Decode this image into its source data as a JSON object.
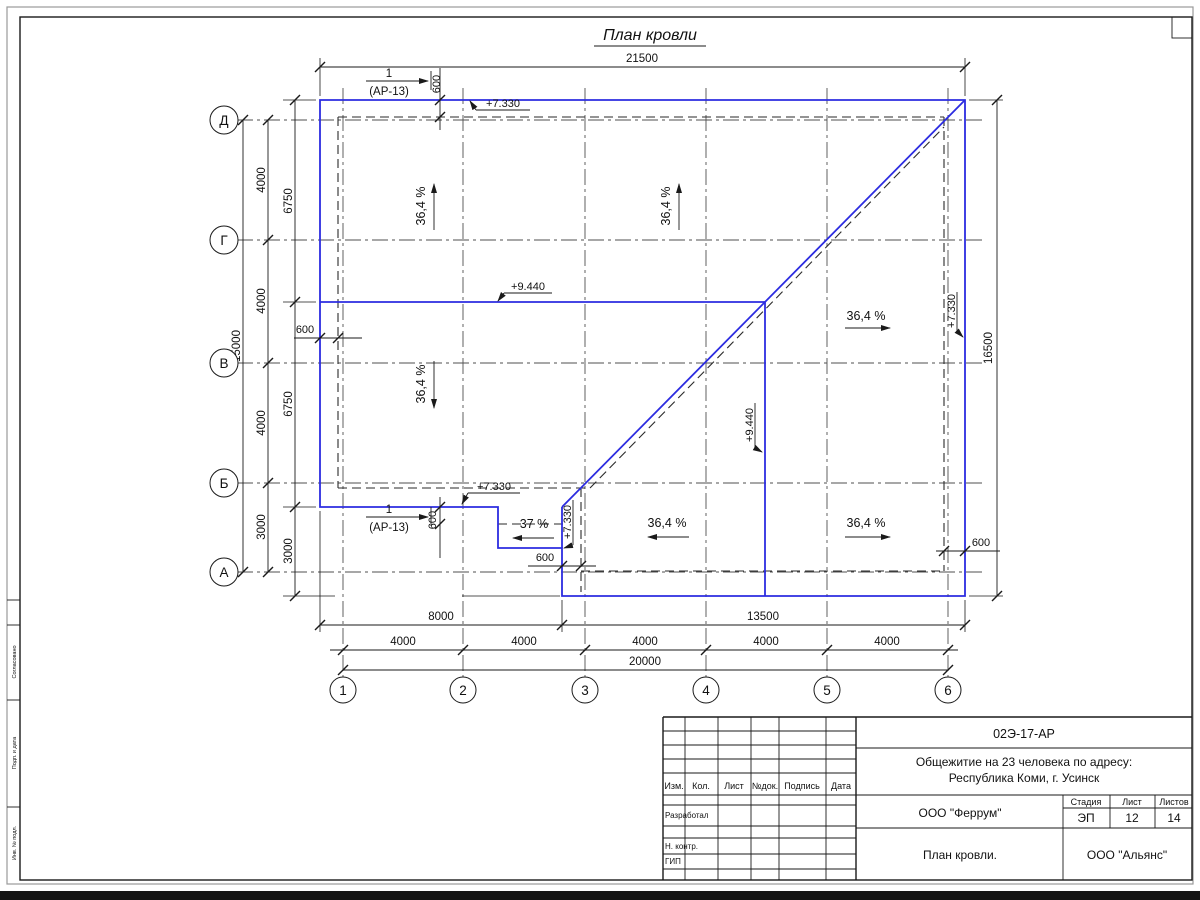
{
  "sheet": {
    "title": "План кровли"
  },
  "axes": {
    "rows": [
      "Д",
      "Г",
      "В",
      "Б",
      "А"
    ],
    "cols": [
      "1",
      "2",
      "3",
      "4",
      "5",
      "6"
    ]
  },
  "dims": {
    "top_total": "21500",
    "left_total": "15000",
    "left_axes": [
      "4000",
      "4000",
      "4000",
      "3000"
    ],
    "left_inner": [
      "6750",
      "6750",
      "3000"
    ],
    "right_total": "16500",
    "bottom_main": [
      "8000",
      "13500"
    ],
    "bottom_axes": [
      "4000",
      "4000",
      "4000",
      "4000",
      "4000"
    ],
    "bottom_total": "20000",
    "overhang": "600"
  },
  "marks": {
    "elev_roof_low": "+7.330",
    "elev_roof_high": "+9.440",
    "section_num": "1",
    "section_ref": "(АР-13)"
  },
  "slopes": {
    "main": "36,4 %",
    "porch": "37 %"
  },
  "title_block": {
    "doc_number": "02Э-17-АР",
    "project_line1": "Общежитие на 23 человека по адресу:",
    "project_line2": "Республика Коми, г. Усинск",
    "designer_org": "ООО \"Феррум\"",
    "sheet_title": "План кровли.",
    "client_org": "ООО \"Альянс\"",
    "stage_label": "Стадия",
    "sheet_label": "Лист",
    "sheets_label": "Листов",
    "stage": "ЭП",
    "sheet": "12",
    "sheets": "14",
    "columns": [
      "Изм.",
      "Кол.",
      "Лист",
      "№док.",
      "Подпись",
      "Дата"
    ],
    "roles": [
      "Разработал",
      "Н. контр.",
      "ГИП"
    ]
  },
  "side_stamp": {
    "box1": "Согласовано",
    "box2": "Подп. и дата",
    "box3": "Инв. № подл."
  }
}
